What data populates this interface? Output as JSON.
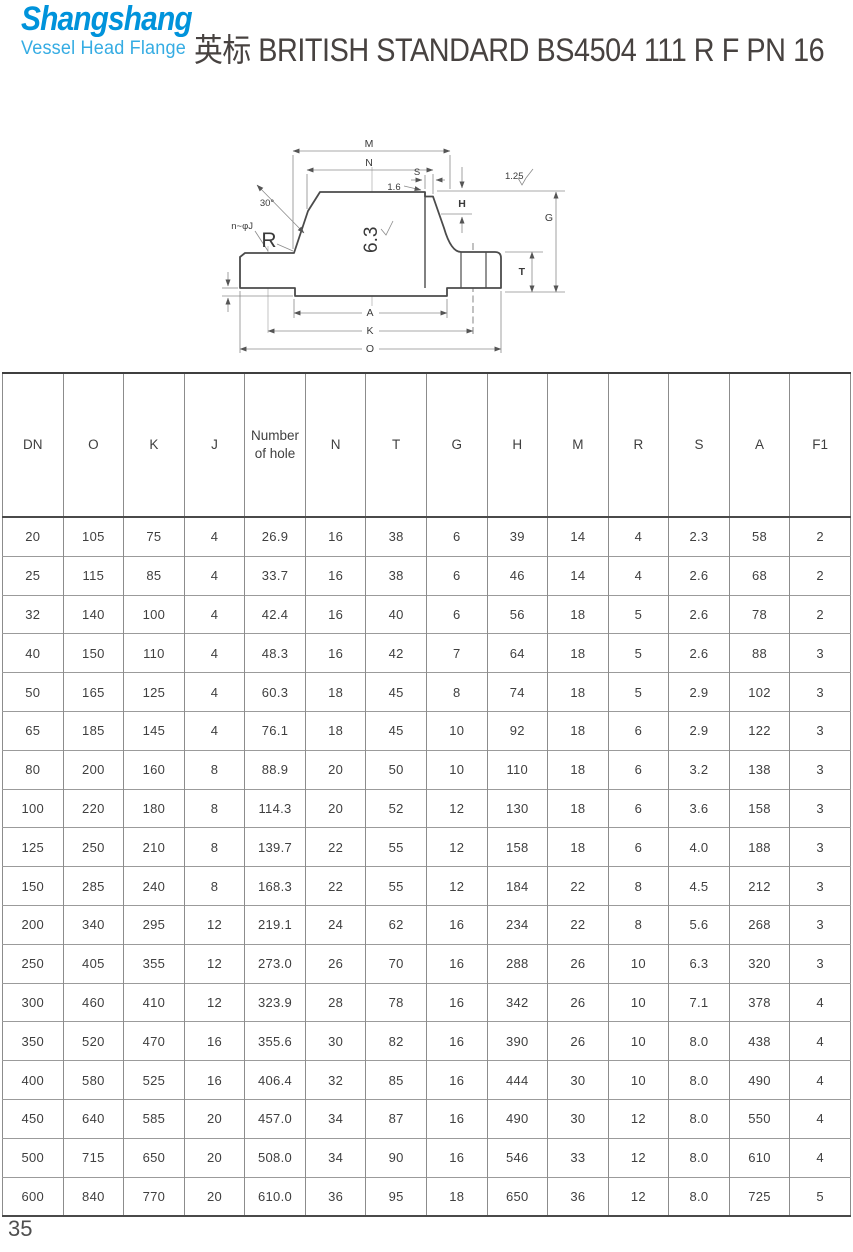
{
  "header": {
    "logo": {
      "line1": "Shangshang",
      "line2": "Vessel Head Flange"
    },
    "title": "英标 BRITISH STANDARD BS4504 111 R F PN 16"
  },
  "colors": {
    "logo_primary": "#0093db",
    "logo_secondary": "#35ace3",
    "title_text": "#474240",
    "table_line": "#8c8c8c"
  },
  "diagram": {
    "labels": {
      "m": "M",
      "n": "N",
      "s": "S",
      "step": "1.6",
      "h": "H",
      "g": "G",
      "surface_finish": "1.25",
      "angle": "30°",
      "holes": "n~φJ",
      "radius": "R",
      "roughness": "6.3",
      "t": "T",
      "a": "A",
      "k": "K",
      "o": "O"
    }
  },
  "table": {
    "headers": [
      "DN",
      "O",
      "K",
      "J",
      "Number of hole",
      "N",
      "T",
      "G",
      "H",
      "M",
      "R",
      "S",
      "A",
      "F1"
    ],
    "rows": [
      [
        "20",
        "105",
        "75",
        "4",
        "26.9",
        "16",
        "38",
        "6",
        "39",
        "14",
        "4",
        "2.3",
        "58",
        "2"
      ],
      [
        "25",
        "115",
        "85",
        "4",
        "33.7",
        "16",
        "38",
        "6",
        "46",
        "14",
        "4",
        "2.6",
        "68",
        "2"
      ],
      [
        "32",
        "140",
        "100",
        "4",
        "42.4",
        "16",
        "40",
        "6",
        "56",
        "18",
        "5",
        "2.6",
        "78",
        "2"
      ],
      [
        "40",
        "150",
        "110",
        "4",
        "48.3",
        "16",
        "42",
        "7",
        "64",
        "18",
        "5",
        "2.6",
        "88",
        "3"
      ],
      [
        "50",
        "165",
        "125",
        "4",
        "60.3",
        "18",
        "45",
        "8",
        "74",
        "18",
        "5",
        "2.9",
        "102",
        "3"
      ],
      [
        "65",
        "185",
        "145",
        "4",
        "76.1",
        "18",
        "45",
        "10",
        "92",
        "18",
        "6",
        "2.9",
        "122",
        "3"
      ],
      [
        "80",
        "200",
        "160",
        "8",
        "88.9",
        "20",
        "50",
        "10",
        "110",
        "18",
        "6",
        "3.2",
        "138",
        "3"
      ],
      [
        "100",
        "220",
        "180",
        "8",
        "114.3",
        "20",
        "52",
        "12",
        "130",
        "18",
        "6",
        "3.6",
        "158",
        "3"
      ],
      [
        "125",
        "250",
        "210",
        "8",
        "139.7",
        "22",
        "55",
        "12",
        "158",
        "18",
        "6",
        "4.0",
        "188",
        "3"
      ],
      [
        "150",
        "285",
        "240",
        "8",
        "168.3",
        "22",
        "55",
        "12",
        "184",
        "22",
        "8",
        "4.5",
        "212",
        "3"
      ],
      [
        "200",
        "340",
        "295",
        "12",
        "219.1",
        "24",
        "62",
        "16",
        "234",
        "22",
        "8",
        "5.6",
        "268",
        "3"
      ],
      [
        "250",
        "405",
        "355",
        "12",
        "273.0",
        "26",
        "70",
        "16",
        "288",
        "26",
        "10",
        "6.3",
        "320",
        "3"
      ],
      [
        "300",
        "460",
        "410",
        "12",
        "323.9",
        "28",
        "78",
        "16",
        "342",
        "26",
        "10",
        "7.1",
        "378",
        "4"
      ],
      [
        "350",
        "520",
        "470",
        "16",
        "355.6",
        "30",
        "82",
        "16",
        "390",
        "26",
        "10",
        "8.0",
        "438",
        "4"
      ],
      [
        "400",
        "580",
        "525",
        "16",
        "406.4",
        "32",
        "85",
        "16",
        "444",
        "30",
        "10",
        "8.0",
        "490",
        "4"
      ],
      [
        "450",
        "640",
        "585",
        "20",
        "457.0",
        "34",
        "87",
        "16",
        "490",
        "30",
        "12",
        "8.0",
        "550",
        "4"
      ],
      [
        "500",
        "715",
        "650",
        "20",
        "508.0",
        "34",
        "90",
        "16",
        "546",
        "33",
        "12",
        "8.0",
        "610",
        "4"
      ],
      [
        "600",
        "840",
        "770",
        "20",
        "610.0",
        "36",
        "95",
        "18",
        "650",
        "36",
        "12",
        "8.0",
        "725",
        "5"
      ]
    ]
  },
  "page_number": "35"
}
